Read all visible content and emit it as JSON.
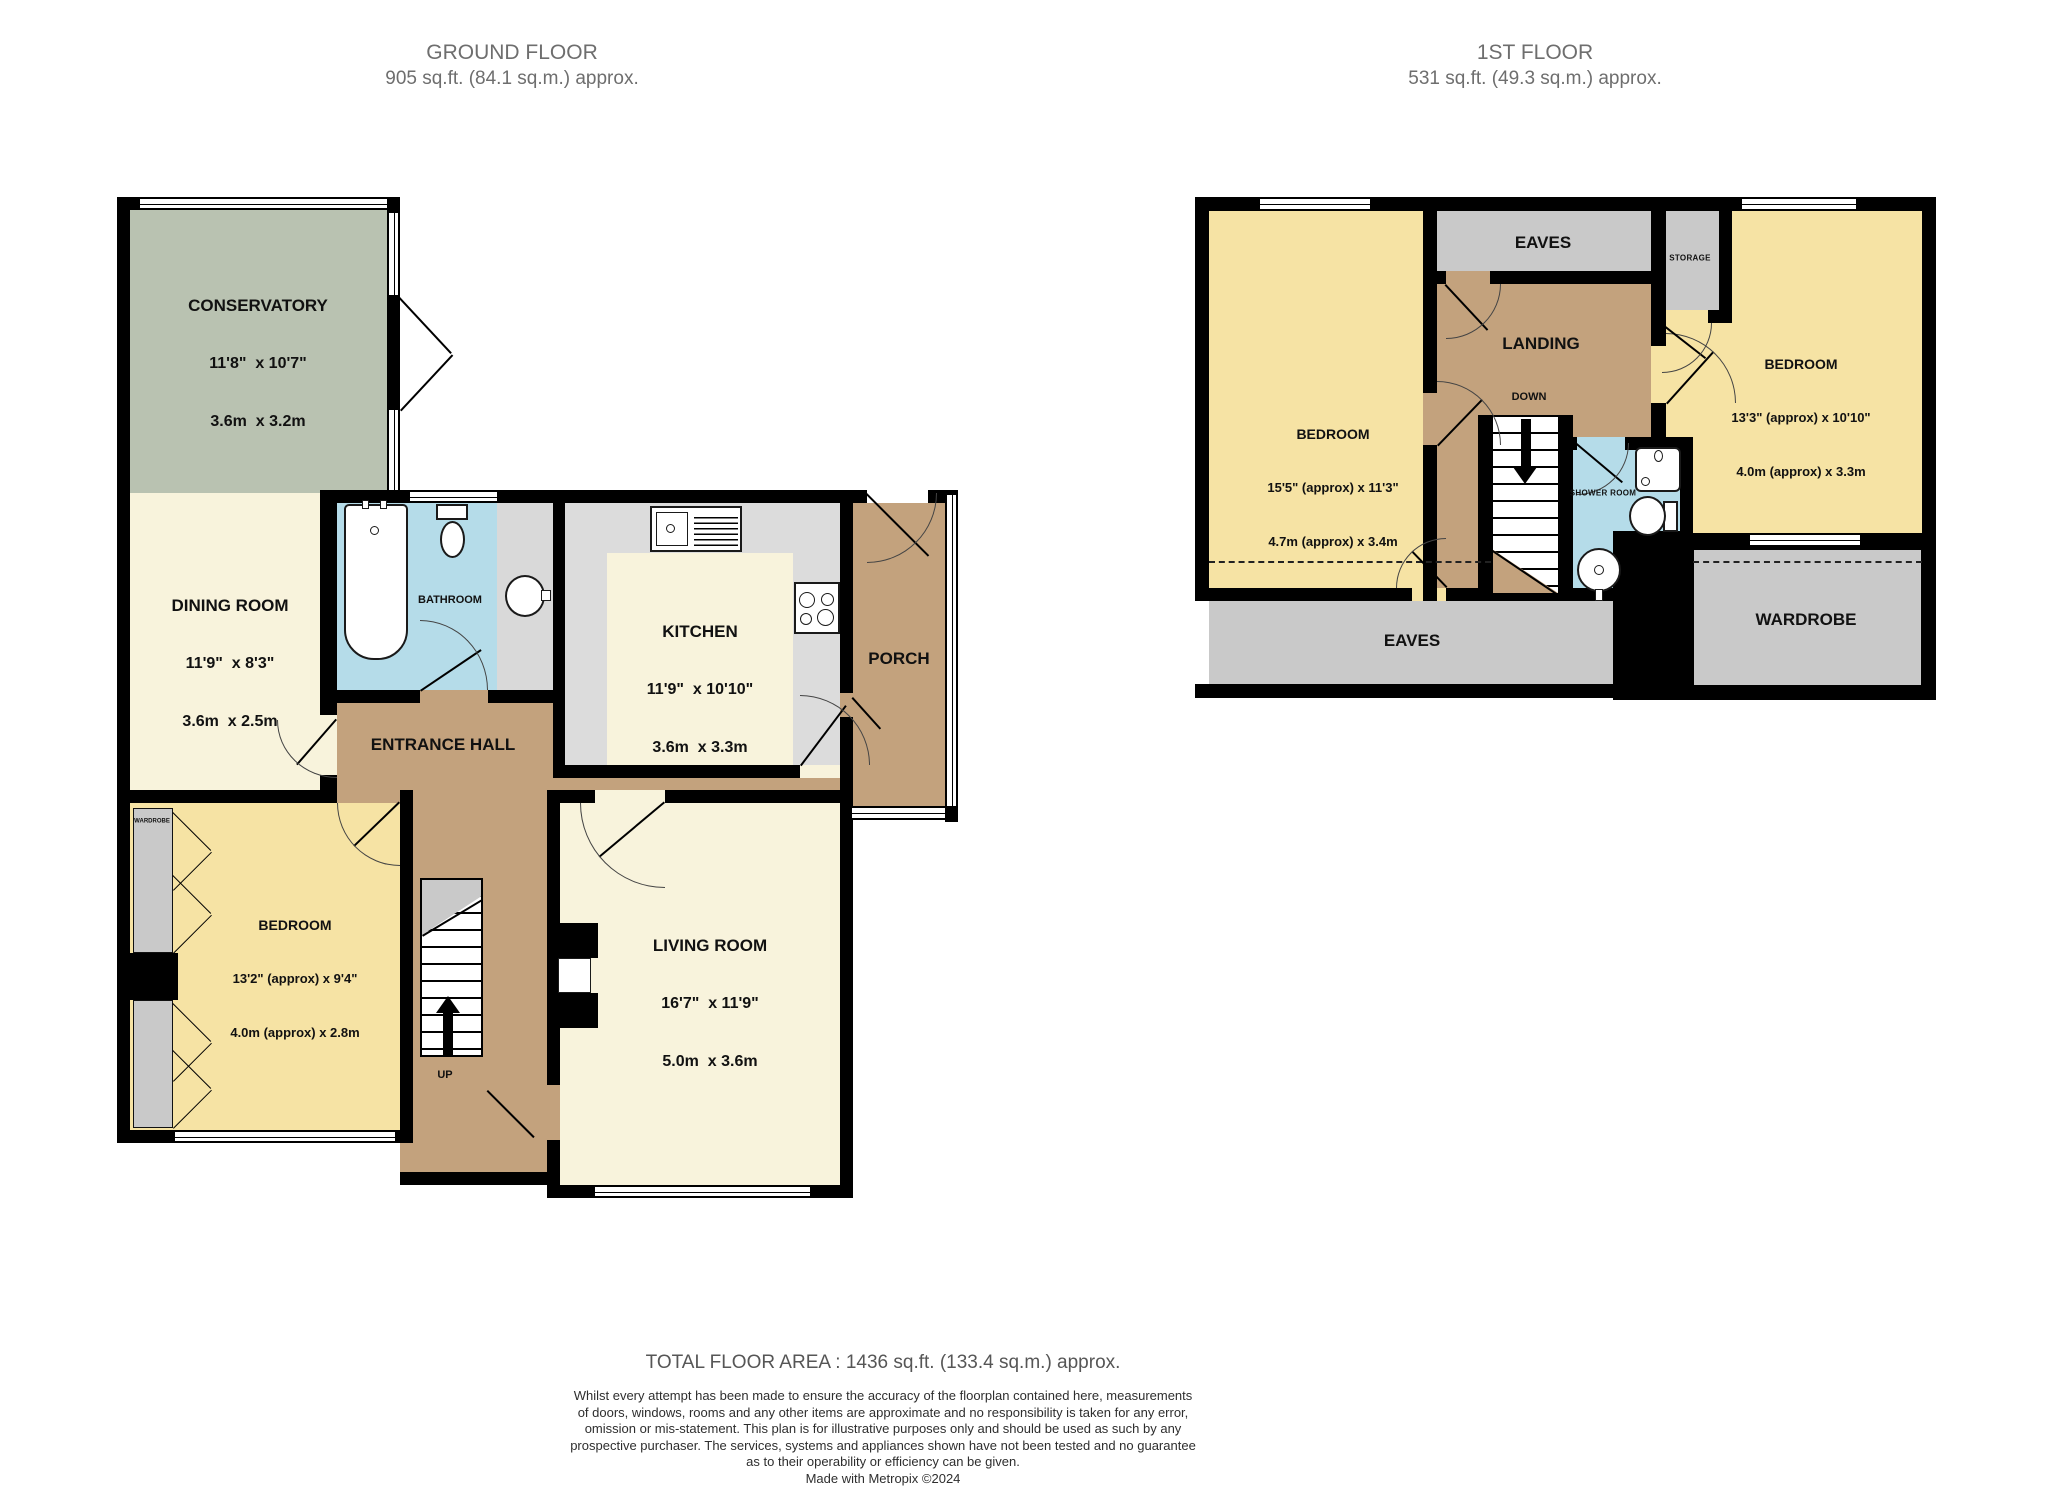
{
  "floors": {
    "ground": {
      "title": "GROUND FLOOR",
      "subtitle": "905 sq.ft. (84.1 sq.m.) approx.",
      "rooms": {
        "conservatory": {
          "name": "CONSERVATORY",
          "imperial": "11'8\"  x 10'7\"",
          "metric": "3.6m  x 3.2m"
        },
        "dining": {
          "name": "DINING ROOM",
          "imperial": "11'9\"  x 8'3\"",
          "metric": "3.6m  x 2.5m"
        },
        "bathroom": {
          "name": "BATHROOM"
        },
        "kitchen": {
          "name": "KITCHEN",
          "imperial": "11'9\"  x 10'10\"",
          "metric": "3.6m  x 3.3m"
        },
        "porch": {
          "name": "PORCH"
        },
        "entrance_hall": {
          "name": "ENTRANCE HALL"
        },
        "bedroom": {
          "name": "BEDROOM",
          "imperial": "13'2\" (approx) x 9'4\"",
          "metric": "4.0m (approx) x 2.8m"
        },
        "living": {
          "name": "LIVING ROOM",
          "imperial": "16'7\"  x 11'9\"",
          "metric": "5.0m  x 3.6m"
        },
        "wardrobe_small": {
          "name": "WARDROBE"
        },
        "stairs_label": "UP"
      }
    },
    "first": {
      "title": "1ST FLOOR",
      "subtitle": "531 sq.ft. (49.3 sq.m.) approx.",
      "rooms": {
        "bedroom_left": {
          "name": "BEDROOM",
          "imperial": "15'5\" (approx) x 11'3\"",
          "metric": "4.7m (approx) x 3.4m"
        },
        "bedroom_right": {
          "name": "BEDROOM",
          "imperial": "13'3\" (approx) x 10'10\"",
          "metric": "4.0m (approx) x 3.3m"
        },
        "eaves_top": {
          "name": "EAVES"
        },
        "eaves_bottom": {
          "name": "EAVES"
        },
        "landing": {
          "name": "LANDING"
        },
        "storage": {
          "name": "STORAGE"
        },
        "shower": {
          "name": "SHOWER ROOM"
        },
        "wardrobe": {
          "name": "WARDROBE"
        },
        "stairs_label": "DOWN"
      }
    }
  },
  "footer": {
    "total": "TOTAL FLOOR AREA : 1436 sq.ft. (133.4 sq.m.) approx.",
    "disclaimer": [
      "Whilst every attempt has been made to ensure the accuracy of the floorplan contained here, measurements",
      "of doors, windows, rooms and any other items are approximate and no responsibility is taken for any error,",
      "omission or mis-statement. This plan is for illustrative purposes only and should be used as such by any",
      "prospective purchaser. The services, systems and appliances shown have not been tested and no guarantee",
      "as to their operability or efficiency can be given."
    ],
    "credit": "Made with Metropix ©2024"
  },
  "colors": {
    "wall": "#000000",
    "room_cream": "#f8f3dc",
    "room_yellow": "#f6e3a4",
    "room_tan": "#c3a27d",
    "room_blue": "#b5dce9",
    "room_gray": "#c9c9c9",
    "room_green": "#b9c2b1",
    "header_text": "#6e6e6e",
    "label_text": "#111111"
  }
}
